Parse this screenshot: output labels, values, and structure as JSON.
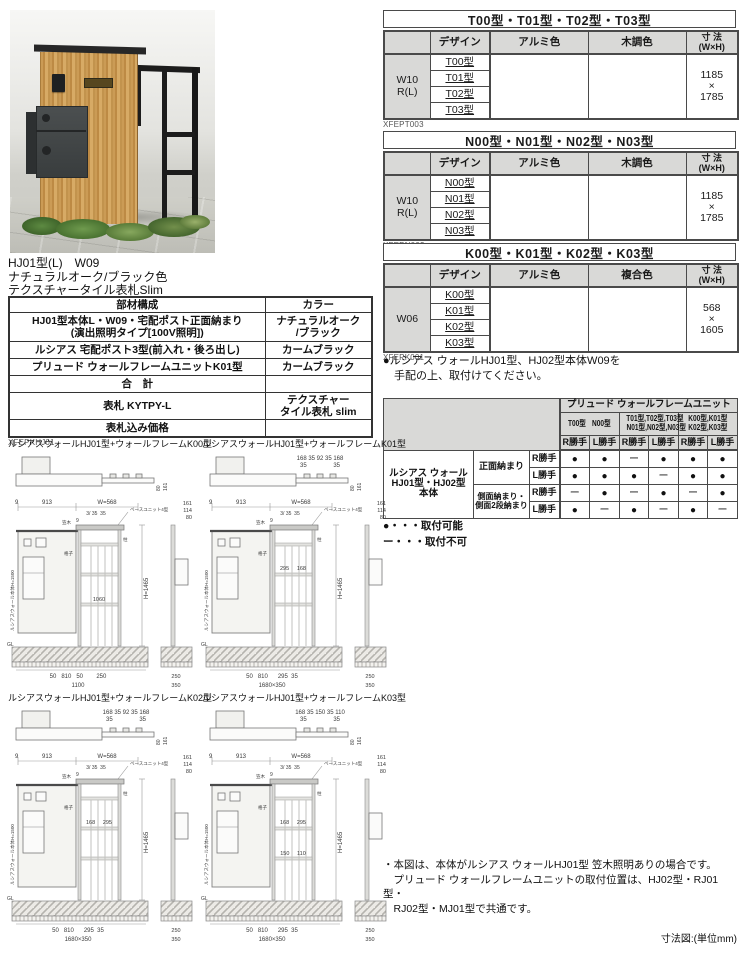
{
  "product": {
    "line1": "HJ01型(L)　W09",
    "line2": "ナチュラルオーク/ブラック色",
    "line3": "テクスチャータイル表札Slim"
  },
  "parts": {
    "code": "XFEPKHJ01",
    "h_part": "部材構成",
    "h_color": "カラー",
    "rows": [
      {
        "part": "HJ01型本体L・W09・宅配ポスト正面納まり\n(演出照明タイプ[100V照明])",
        "color": "ナチュラルオーク\n/ブラック"
      },
      {
        "part": "ルシアス 宅配ポスト3型(前入れ・後ろ出し)",
        "color": "カームブラック"
      },
      {
        "part": "プリュード ウォールフレームユニットK01型",
        "color": "カームブラック"
      },
      {
        "part": "合　計",
        "color": ""
      },
      {
        "part": "表札 KYTPY-L",
        "color": "テクスチャー\nタイル表札 slim"
      },
      {
        "part": "表札込み価格",
        "color": ""
      }
    ]
  },
  "spec": [
    {
      "title": "T00型・T01型・T02型・T03型",
      "code": "XFEPT003",
      "h_design": "デザイン",
      "h_col1": "アルミ色",
      "h_col2": "木調色",
      "h_size": "寸 法\n(W×H)",
      "stub": "W10\nR(L)",
      "designs": [
        "T00型",
        "T01型",
        "T02型",
        "T03型"
      ],
      "size": "1185\n×\n1785"
    },
    {
      "title": "N00型・N01型・N02型・N03型",
      "code": "XFEPN003",
      "h_design": "デザイン",
      "h_col1": "アルミ色",
      "h_col2": "木調色",
      "h_size": "寸 法\n(W×H)",
      "stub": "W10\nR(L)",
      "designs": [
        "N00型",
        "N01型",
        "N02型",
        "N03型"
      ],
      "size": "1185\n×\n1785"
    },
    {
      "title": "K00型・K01型・K02型・K03型",
      "code": "XFEPK001",
      "h_design": "デザイン",
      "h_col1": "アルミ色",
      "h_col2": "複合色",
      "h_size": "寸 法\n(W×H)",
      "stub": "W06",
      "designs": [
        "K00型",
        "K01型",
        "K02型",
        "K03型"
      ],
      "size": "568\n×\n1605"
    }
  ],
  "k_note": "●ルシアス ウォールHJ01型、HJ02型本体W09を\n　手配の上、取付けてください。",
  "compat": {
    "group_header": "プリュード ウォールフレームユニット",
    "groups": [
      {
        "l1": "T00型",
        "l2": "N00型"
      },
      {
        "l1": "T01型,T02型,T03型",
        "l2": "N01型,N02型,N03型"
      },
      {
        "l1": "K00型,K01型",
        "l2": "K02型,K03型"
      }
    ],
    "stub": "ルシアス ウォール\nHJ01型・HJ02型\n本体",
    "row_group1": "正面納まり",
    "row_group2": "側面納まり・\n側面2段納まり",
    "rows": [
      {
        "hand": "R勝手",
        "cells": [
          "●",
          "●",
          "ー",
          "●",
          "●",
          "●"
        ]
      },
      {
        "hand": "L勝手",
        "cells": [
          "●",
          "●",
          "●",
          "ー",
          "●",
          "●"
        ]
      },
      {
        "hand": "R勝手",
        "cells": [
          "ー",
          "●",
          "ー",
          "●",
          "ー",
          "●"
        ]
      },
      {
        "hand": "L勝手",
        "cells": [
          "●",
          "ー",
          "●",
          "ー",
          "●",
          "ー"
        ]
      }
    ],
    "legend1": "●・・・取付可能",
    "legend2": "ー・・・取付不可"
  },
  "drawings": [
    {
      "title": "ルシアスウォールHJ01型+ウォールフレームK00型",
      "top1": "",
      "top2": "",
      "tside1": "80",
      "tside2": "161",
      "f9": "9",
      "f913": "913",
      "fw": "W=568",
      "fsub": "3/ 35  35",
      "f9b": "9",
      "base": "ベースユニット4型",
      "kasagi": "笠木",
      "koushi": "格子",
      "hashira": "柱",
      "mida": "",
      "midb": "1060",
      "h": "H=1465",
      "g1": "100",
      "g2": "350",
      "g3": "450",
      "bottom": "50   810   50        250",
      "total": "1100",
      "s1": "161",
      "s2": "114",
      "s3": "80",
      "sb1": "250",
      "sb2": "350",
      "wall": "ルシアスウォール本体H=1500",
      "gl": "GL"
    },
    {
      "title": "ルシアスウォールHJ01型+ウォールフレームK01型",
      "top1": "168 35 92 35 168",
      "top2": "35                35",
      "tside1": "80",
      "tside2": "161",
      "f9": "9",
      "f913": "913",
      "fw": "W=568",
      "fsub": "3/ 35  35",
      "f9b": "9",
      "base": "ベースユニット4型",
      "kasagi": "笠木",
      "koushi": "格子",
      "hashira": "柱",
      "mida": "295     168",
      "midb": "",
      "h": "H=1465",
      "g1": "100",
      "g2": "350",
      "g3": "450",
      "bottom": "50   810      295  35",
      "total": "1680×350",
      "s1": "161",
      "s2": "114",
      "s3": "80",
      "sb1": "250",
      "sb2": "350",
      "wall": "ルシアスウォール本体H=1500",
      "gl": "GL"
    },
    {
      "title": "ルシアスウォールHJ01型+ウォールフレームK02型",
      "top1": "168 35 92 35 168",
      "top2": "35                35",
      "tside1": "80",
      "tside2": "161",
      "f9": "9",
      "f913": "913",
      "fw": "W=568",
      "fsub": "3/ 35  35",
      "f9b": "9",
      "base": "ベースユニット4型",
      "kasagi": "笠木",
      "koushi": "格子",
      "hashira": "柱",
      "mida": "168     295",
      "midb": "",
      "h": "H=1465",
      "g1": "100",
      "g2": "360",
      "g3": "450",
      "bottom": "50   810      295  35",
      "total": "1680×350",
      "s1": "161",
      "s2": "114",
      "s3": "80",
      "sb1": "250",
      "sb2": "350",
      "wall": "ルシアスウォール本体H=1500",
      "gl": "GL"
    },
    {
      "title": "ルシアスウォールHJ01型+ウォールフレームK03型",
      "top1": "168 35 150 35 110",
      "top2": "35                35",
      "tside1": "80",
      "tside2": "161",
      "f9": "9",
      "f913": "913",
      "fw": "W=568",
      "fsub": "3/ 35  35",
      "f9b": "9",
      "base": "ベースユニット4型",
      "kasagi": "笠木",
      "koushi": "格子",
      "hashira": "柱",
      "mida": "168     295",
      "midb": "150     110",
      "h": "H=1465",
      "g1": "100",
      "g2": "350",
      "g3": "450",
      "bottom": "50   810      295  35",
      "total": "1680×350",
      "s1": "161",
      "s2": "114",
      "s3": "80",
      "sb1": "250",
      "sb2": "350",
      "wall": "ルシアスウォール本体H=1500",
      "gl": "GL"
    }
  ],
  "footer": {
    "note": "・本図は、本体がルシアス ウォールHJ01型 笠木照明ありの場合です。\n　プリュード ウォールフレームユニットの取付位置は、HJ02型・RJ01型・\n　RJ02型・MJ01型で共通です。",
    "unit": "寸法図:(単位mm)"
  }
}
